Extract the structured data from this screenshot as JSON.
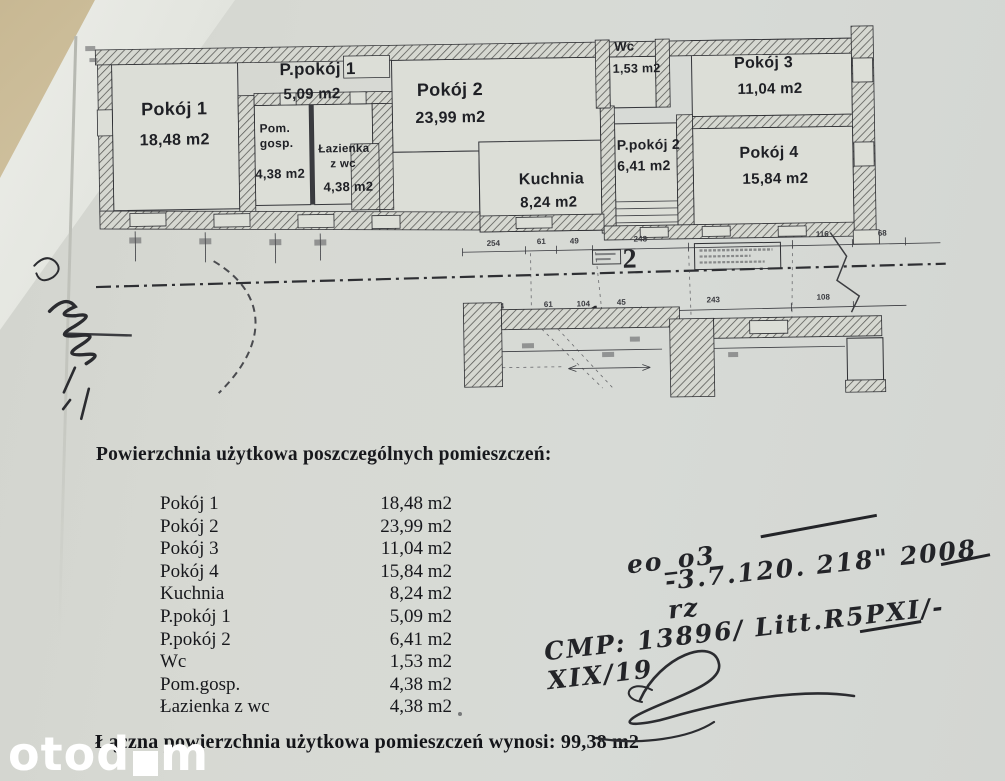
{
  "plan": {
    "rooms": [
      {
        "name": "Pokój 1",
        "area": "18,48 m2"
      },
      {
        "name": "P.pokój 1",
        "area": "5,09 m2"
      },
      {
        "name": "Pom. gosp.",
        "name_line1": "Pom.",
        "name_line2": "gosp.",
        "area": "4,38 m2"
      },
      {
        "name": "Łazienka z wc",
        "name_line1": "Łazienka",
        "name_line2": "z wc",
        "area": "4,38 m2"
      },
      {
        "name": "Pokój 2",
        "area": "23,99 m2"
      },
      {
        "name": "Kuchnia",
        "area": "8,24 m2"
      },
      {
        "name": "Wc",
        "area": "1,53 m2"
      },
      {
        "name": "P.pokój 2",
        "area": "6,41 m2"
      },
      {
        "name": "Pokój 3",
        "area": "11,04 m2"
      },
      {
        "name": "Pokój 4",
        "area": "15,84 m2"
      }
    ],
    "unit_labels": {
      "unit_2": "2",
      "unit_1": "1"
    },
    "dims_top": [
      "254",
      "61",
      "49",
      "248",
      "116",
      "68"
    ],
    "dims_bottom": [
      "254",
      "61",
      "104",
      "45",
      "243",
      "108"
    ]
  },
  "summary": {
    "heading": "Powierzchnia użytkowa poszczególnych pomieszczeń:",
    "rows": [
      {
        "label": "Pokój 1",
        "value": "18,48 m2"
      },
      {
        "label": "Pokój 2",
        "value": "23,99 m2"
      },
      {
        "label": "Pokój 3",
        "value": "11,04 m2"
      },
      {
        "label": "Pokój 4",
        "value": "15,84 m2"
      },
      {
        "label": "Kuchnia",
        "value": "8,24 m2"
      },
      {
        "label": "P.pokój 1",
        "value": "5,09 m2"
      },
      {
        "label": "P.pokój 2",
        "value": "6,41 m2"
      },
      {
        "label": "Wc",
        "value": "1,53 m2"
      },
      {
        "label": "Pom.gosp.",
        "value": "4,38 m2"
      },
      {
        "label": "Łazienka z wc",
        "value": "4,38 m2"
      }
    ],
    "total": "Łączna powierzchnia użytkowa pomieszczeń wynosi: 99,38 m2"
  },
  "handwriting": {
    "line1": "eo_o3",
    "line2": "-3.7.120. 218\" 2008 rz",
    "line3": "CMP: 13896/ Litt.R5PXI/-XIX/19"
  },
  "watermark": {
    "part1": "otod",
    "part2": "m"
  }
}
